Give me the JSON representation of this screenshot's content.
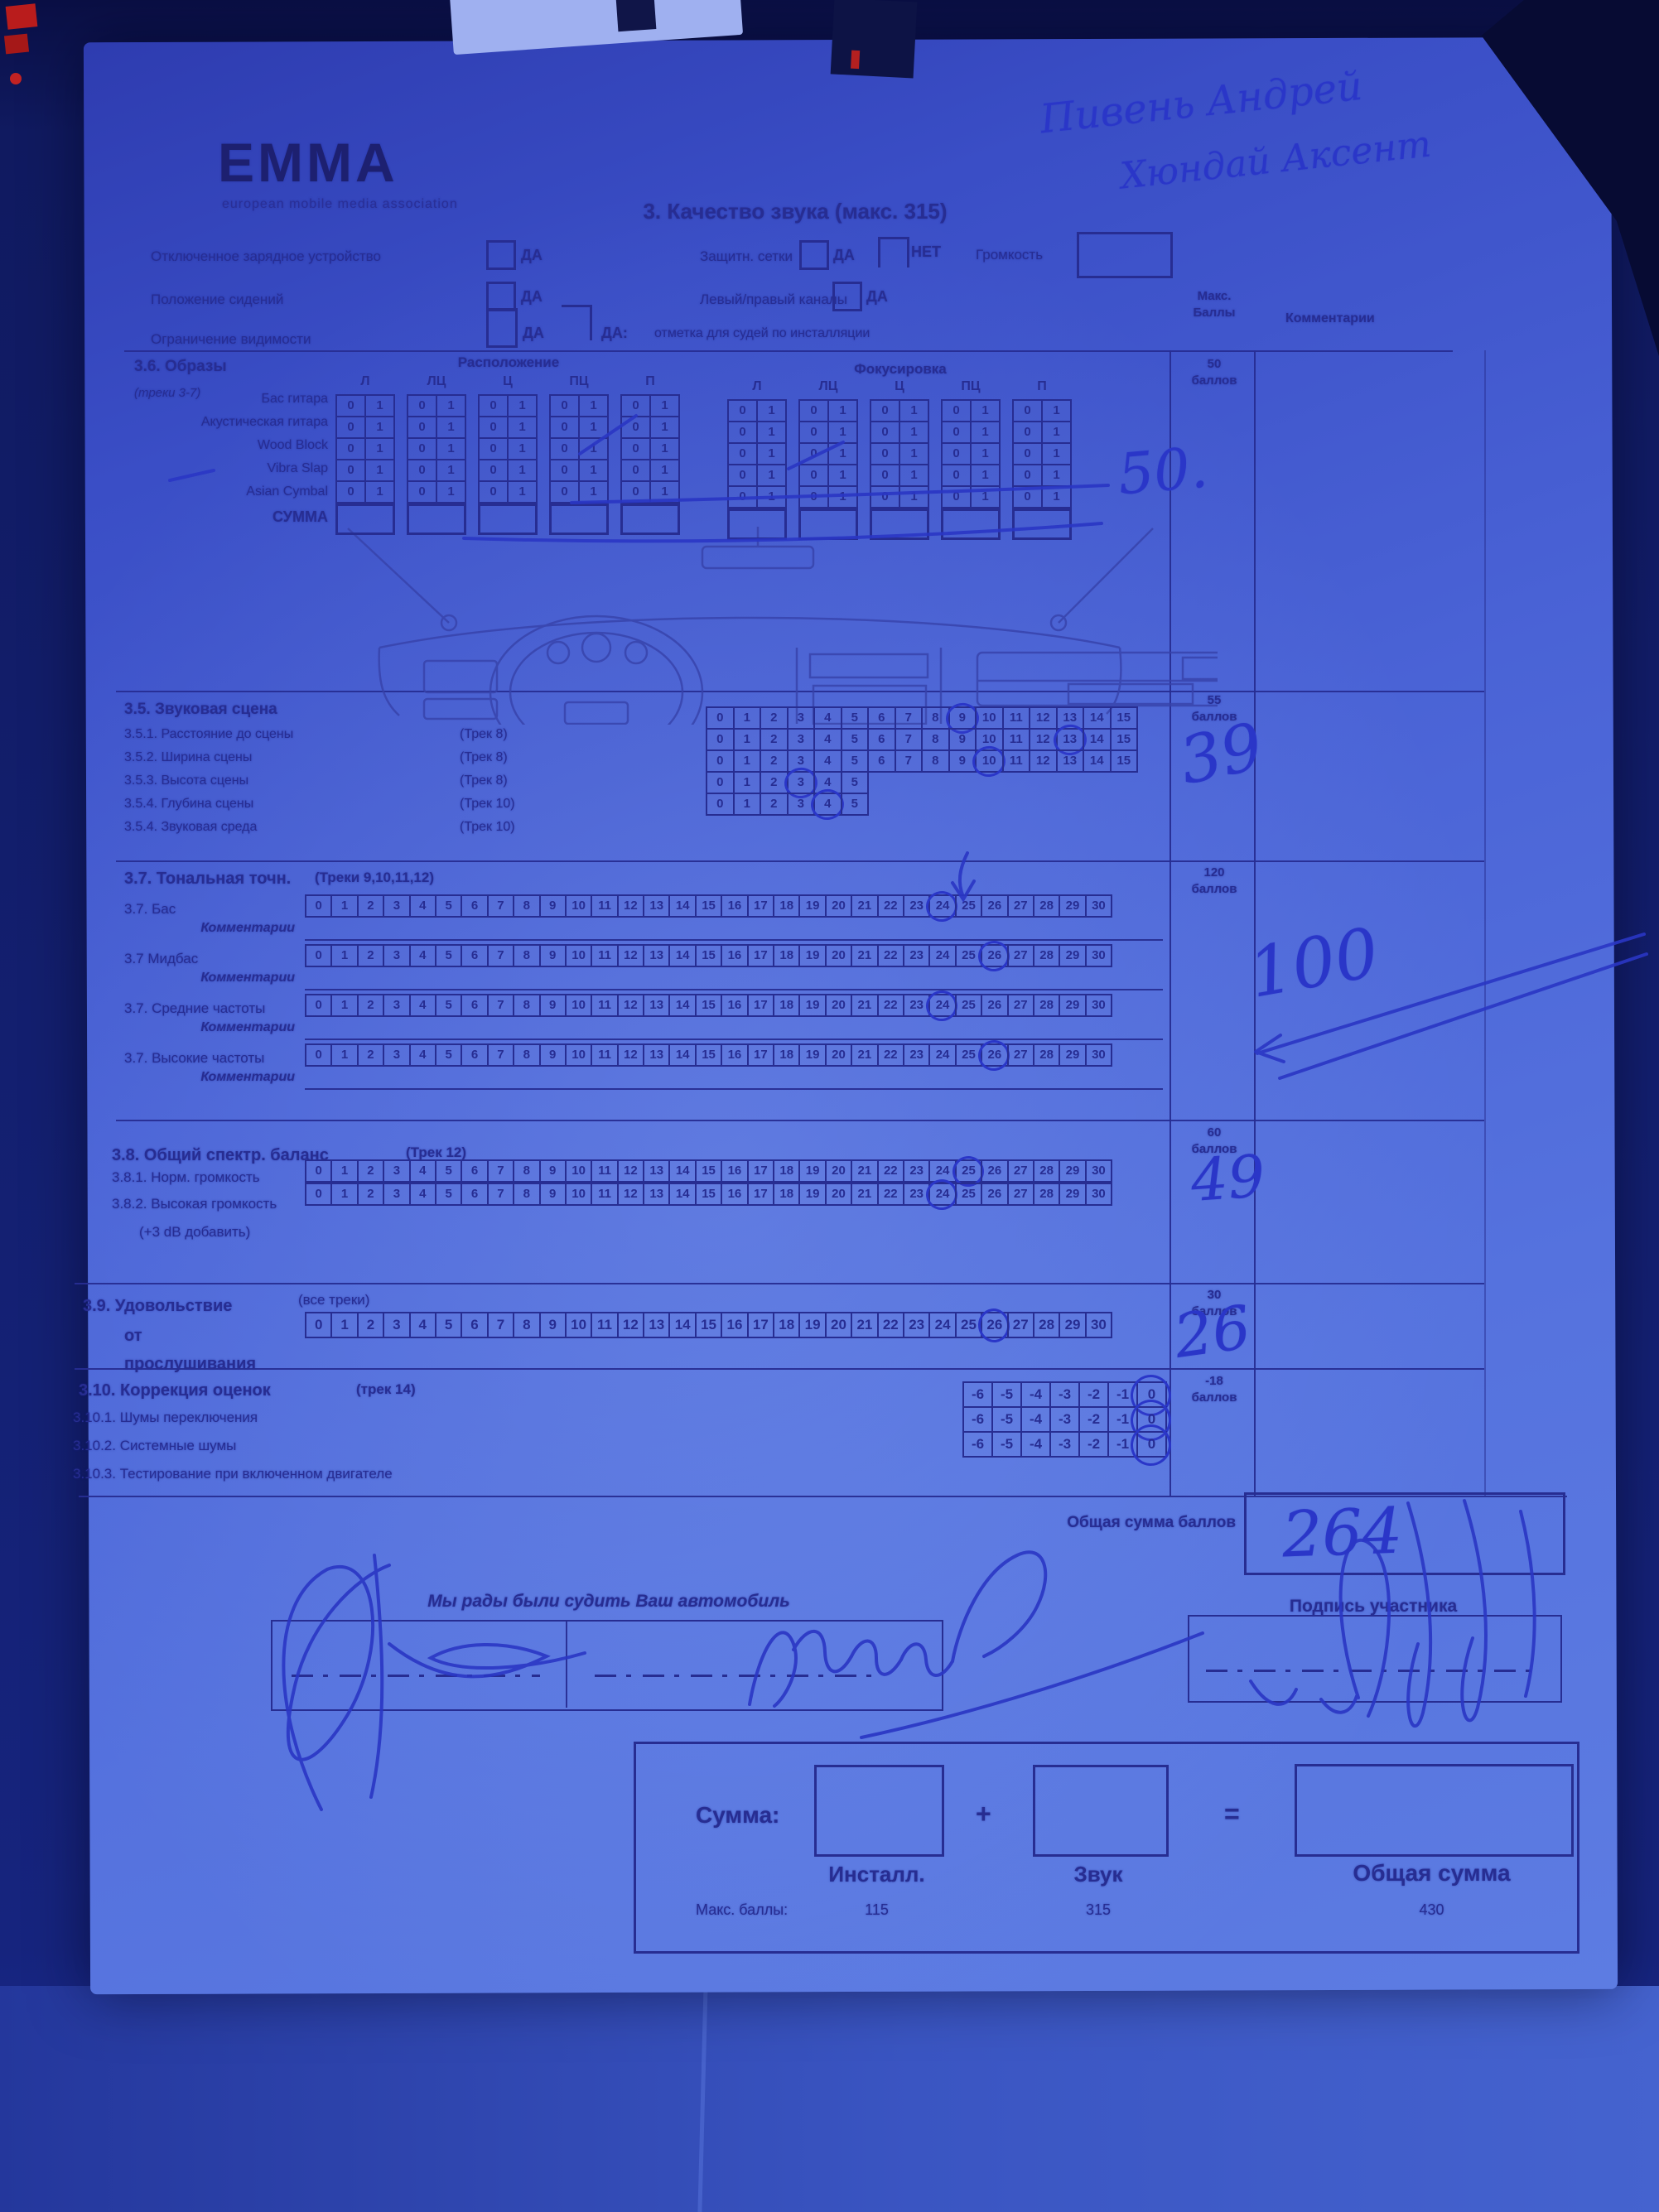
{
  "colors": {
    "paper_tint": "#4a63d0",
    "print_ink": "#272d92",
    "pen_ink": "#2a36c8"
  },
  "logo": {
    "name": "EMMA",
    "subtitle": "european mobile media association"
  },
  "title": "3. Качество звука (макс. 315)",
  "handwriting": {
    "name_line1": "Пивень Андрей",
    "name_line2": "Хюндай Аксент"
  },
  "header_fields": {
    "charger": {
      "label": "Отключенное зарядное устройство",
      "yes": "ДА"
    },
    "seats": {
      "label": "Положение сидений",
      "yes": "ДА"
    },
    "visibility": {
      "label": "Ограничение видимости",
      "yes": "ДА"
    },
    "judge_note": {
      "prefix": "ДА:",
      "text": "отметка для судей по инсталляции"
    },
    "grilles": {
      "label": "Защитн. сетки",
      "yes": "ДА",
      "no": "НЕТ"
    },
    "volume_label": "Громкость",
    "channels": {
      "label": "Левый/правый каналы",
      "yes": "ДА"
    }
  },
  "score_columns": {
    "max_header": "Макс.\nБаллы",
    "comments_header": "Комментарии"
  },
  "section_36": {
    "title": "3.6. Образы",
    "tracks": "(треки 3-7)",
    "group_headers": [
      "Расположение",
      "Фокусировка"
    ],
    "col_headers": [
      "Л",
      "ЛЦ",
      "Ц",
      "ПЦ",
      "П"
    ],
    "rows": [
      "Бас гитара",
      "Акустическая гитара",
      "Wood Block",
      "Vibra Slap",
      "Asian Cymbal"
    ],
    "sum_label": "СУММА",
    "cell_values": [
      "0",
      "1"
    ],
    "max_score": "50\nбаллов",
    "handwritten_score": "50."
  },
  "section_35": {
    "title": "3.5. Звуковая сцена",
    "max_score": "55\nбаллов",
    "handwritten_score": "39",
    "rows": [
      {
        "label": "3.5.1. Расстояние до сцены",
        "track": "(Трек 8)",
        "scale_max": 15,
        "circled": 9
      },
      {
        "label": "3.5.2. Ширина сцены",
        "track": "(Трек 8)",
        "scale_max": 15,
        "circled": 13
      },
      {
        "label": "3.5.3. Высота сцены",
        "track": "(Трек 8)",
        "scale_max": 15,
        "circled": 10
      },
      {
        "label": "3.5.4. Глубина сцены",
        "track": "(Трек 10)",
        "scale_max": 5,
        "circled": 3
      },
      {
        "label": "3.5.4. Звуковая среда",
        "track": "(Трек 10)",
        "scale_max": 5,
        "circled": 4
      }
    ]
  },
  "section_37": {
    "title": "3.7. Тональная точн.",
    "tracks": "(Треки 9,10,11,12)",
    "max_score": "120\nбаллов",
    "handwritten_score": "100",
    "comments_label": "Комментарии",
    "rows": [
      {
        "label": "3.7. Бас",
        "scale_max": 30,
        "circled": 24
      },
      {
        "label": "3.7 Мидбас",
        "scale_max": 30,
        "circled": 26
      },
      {
        "label": "3.7. Средние частоты",
        "scale_max": 30,
        "circled": 24
      },
      {
        "label": "3.7. Высокие частоты",
        "scale_max": 30,
        "circled": 26
      }
    ]
  },
  "section_38": {
    "title": "3.8. Общий спектр. баланс",
    "track": "(Трек 12)",
    "max_score": "60\nбаллов",
    "handwritten_score": "49",
    "note": "(+3 dB добавить)",
    "rows": [
      {
        "label": "3.8.1. Норм. громкость",
        "scale_max": 30,
        "circled": 25
      },
      {
        "label": "3.8.2. Высокая громкость",
        "scale_max": 30,
        "circled": 24
      }
    ]
  },
  "section_39": {
    "title_line1": "3.9. Удовольствие",
    "title_line2": "от",
    "title_line3": "прослушивания",
    "tracks": "(все треки)",
    "max_score": "30\nбаллов",
    "handwritten_score": "26",
    "row": {
      "scale_max": 30,
      "circled": 26
    }
  },
  "section_310": {
    "title": "3.10. Коррекция оценок",
    "track": "(трек 14)",
    "max_score": "-18\nбаллов",
    "rows": [
      {
        "label": "3.10.1. Шумы переключения",
        "scale": [
          "-6",
          "-5",
          "-4",
          "-3",
          "-2",
          "-1",
          "0"
        ],
        "circled": "0"
      },
      {
        "label": "3.10.2. Системные шумы",
        "scale": [
          "-6",
          "-5",
          "-4",
          "-3",
          "-2",
          "-1",
          "0"
        ],
        "circled": "0"
      },
      {
        "label": "3.10.3. Тестирование при включенном двигателе",
        "scale": [
          "-6",
          "-5",
          "-4",
          "-3",
          "-2",
          "-1",
          "0"
        ],
        "circled": "0"
      }
    ]
  },
  "total": {
    "label": "Общая сумма баллов",
    "handwritten": "264"
  },
  "signatures": {
    "judge_caption": "Мы рады были судить Ваш автомобиль",
    "participant_caption": "Подпись участника"
  },
  "summary_box": {
    "sum_label": "Сумма:",
    "plus": "+",
    "equals": "=",
    "col1_label": "Инсталл.",
    "col2_label": "Звук",
    "col3_label": "Общая сумма",
    "max_label": "Макс. баллы:",
    "max1": "115",
    "max2": "315",
    "max3": "430"
  }
}
